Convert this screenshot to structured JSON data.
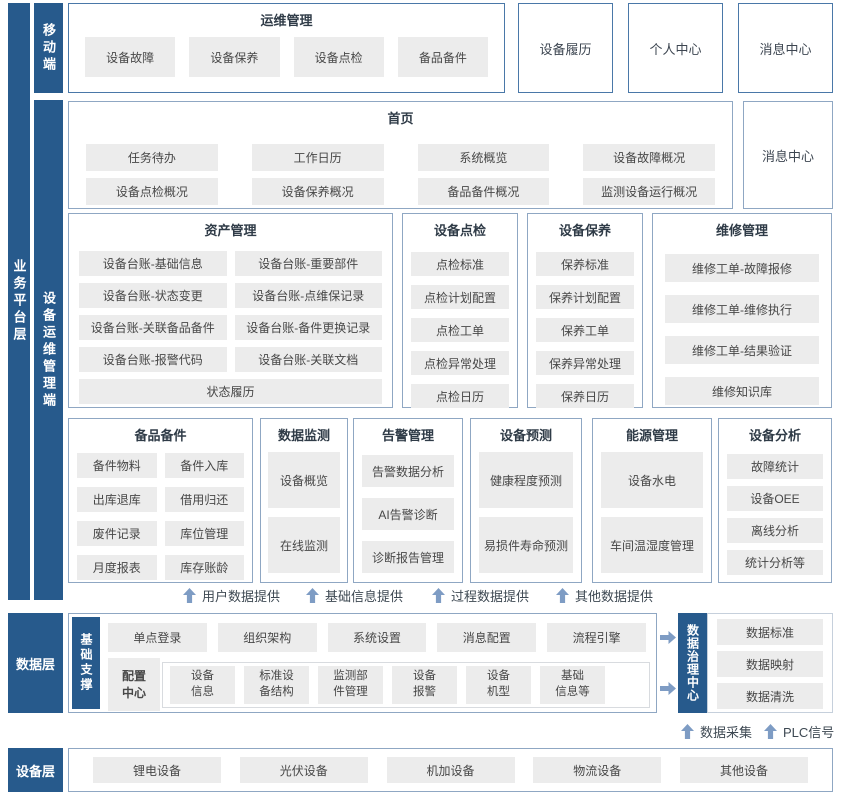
{
  "layers": {
    "business": "业务平台层",
    "mobile": "移动端",
    "devops": "设备运维管理端",
    "data": "数据层",
    "base_support": "基础支撑",
    "data_governance": "数据治理中心",
    "device": "设备层"
  },
  "row1": {
    "ops": {
      "title": "运维管理",
      "items": [
        "设备故障",
        "设备保养",
        "设备点检",
        "备品备件"
      ]
    },
    "standalone": [
      "设备履历",
      "个人中心",
      "消息中心"
    ]
  },
  "row2": {
    "home": {
      "title": "首页",
      "items": [
        "任务待办",
        "工作日历",
        "系统概览",
        "设备故障概况",
        "设备点检概况",
        "设备保养概况",
        "备品备件概况",
        "监测设备运行概况"
      ]
    },
    "standalone": "消息中心"
  },
  "row3": [
    {
      "title": "资产管理",
      "items": [
        "设备台账-基础信息",
        "设备台账-重要部件",
        "设备台账-状态变更",
        "设备台账-点维保记录",
        "设备台账-关联备品备件",
        "设备台账-备件更换记录",
        "设备台账-报警代码",
        "设备台账-关联文档",
        "状态履历"
      ]
    },
    {
      "title": "设备点检",
      "items": [
        "点检标准",
        "点检计划配置",
        "点检工单",
        "点检异常处理",
        "点检日历"
      ]
    },
    {
      "title": "设备保养",
      "items": [
        "保养标准",
        "保养计划配置",
        "保养工单",
        "保养异常处理",
        "保养日历"
      ]
    },
    {
      "title": "维修管理",
      "items": [
        "维修工单-故障报修",
        "维修工单-维修执行",
        "维修工单-结果验证",
        "维修知识库"
      ]
    }
  ],
  "row4": [
    {
      "title": "备品备件",
      "items": [
        "备件物料",
        "备件入库",
        "出库退库",
        "借用归还",
        "废件记录",
        "库位管理",
        "月度报表",
        "库存账龄"
      ]
    },
    {
      "title": "数据监测",
      "items": [
        "设备概览",
        "在线监测"
      ]
    },
    {
      "title": "告警管理",
      "items": [
        "告警数据分析",
        "AI告警诊断",
        "诊断报告管理"
      ]
    },
    {
      "title": "设备预测",
      "items": [
        "健康程度预测",
        "易损件寿命预测"
      ]
    },
    {
      "title": "能源管理",
      "items": [
        "设备水电",
        "车间温湿度管理"
      ]
    },
    {
      "title": "设备分析",
      "items": [
        "故障统计",
        "设备OEE",
        "离线分析",
        "统计分析等"
      ]
    }
  ],
  "flow_up_labels": [
    "用户数据提供",
    "基础信息提供",
    "过程数据提供",
    "其他数据提供"
  ],
  "data_layer": {
    "top_items": [
      "单点登录",
      "组织架构",
      "系统设置",
      "消息配置",
      "流程引擎"
    ],
    "config_center": "配置\n中心",
    "config_items": [
      "设备\n信息",
      "标准设\n备结构",
      "监测部\n件管理",
      "设备\n报警",
      "设备\n机型",
      "基础\n信息等"
    ],
    "governance_items": [
      "数据标准",
      "数据映射",
      "数据清洗"
    ],
    "bottom_labels": [
      "数据采集",
      "PLC信号"
    ]
  },
  "device_layer": {
    "items": [
      "锂电设备",
      "光伏设备",
      "机加设备",
      "物流设备",
      "其他设备"
    ]
  },
  "colors": {
    "primary_bar": "#275a8c",
    "border_strong": "#4a78a8",
    "border_soft": "#8fa7c3",
    "chip_bg": "#ececec",
    "arrow": "#7e9cc4"
  }
}
